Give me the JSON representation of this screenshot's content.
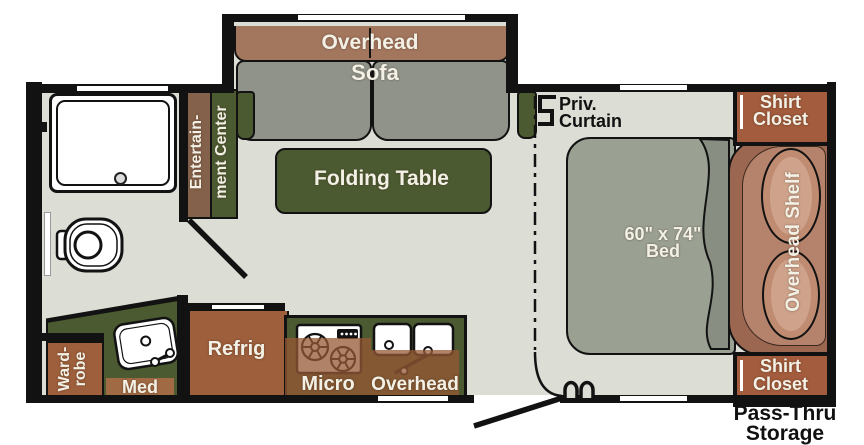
{
  "title": "Travel trailer floor plan",
  "colors": {
    "floor": "#dcddd5",
    "wall": "#121212",
    "cabinet_brown": "#9d5f3c",
    "closet_brown": "#a35c3d",
    "overlay_brown": "rgba(150,88,52,0.75)",
    "accent_green": "#4b5a31",
    "sofa_gray": "#8f938a",
    "bed_gray": "#9aa092",
    "overhead_band_brown": "#a3765e",
    "headboard_brown": "#9c6750",
    "pillow_brown": "#bf8c72"
  },
  "living_area": {
    "overhead_cabinet": "Overhead",
    "sofa": "Sofa",
    "folding_table": "Folding Table",
    "entertainment_line1": "Entertain-",
    "entertainment_line2": "ment Center"
  },
  "kitchen": {
    "refrigerator": "Refrig",
    "microwave": "Micro",
    "overhead_cabinet": "Overhead"
  },
  "bathroom": {
    "wardrobe": "Ward-\nrobe",
    "medicine_cabinet": "Med"
  },
  "bedroom": {
    "privacy_curtain": "Priv.\nCurtain",
    "bed": "60\" x 74\"\nBed",
    "overhead_shelf": "Overhead Shelf",
    "shirt_closet_top": "Shirt\nCloset",
    "shirt_closet_bottom": "Shirt\nCloset"
  },
  "exterior": {
    "pass_thru_storage": "Pass-Thru\nStorage"
  }
}
